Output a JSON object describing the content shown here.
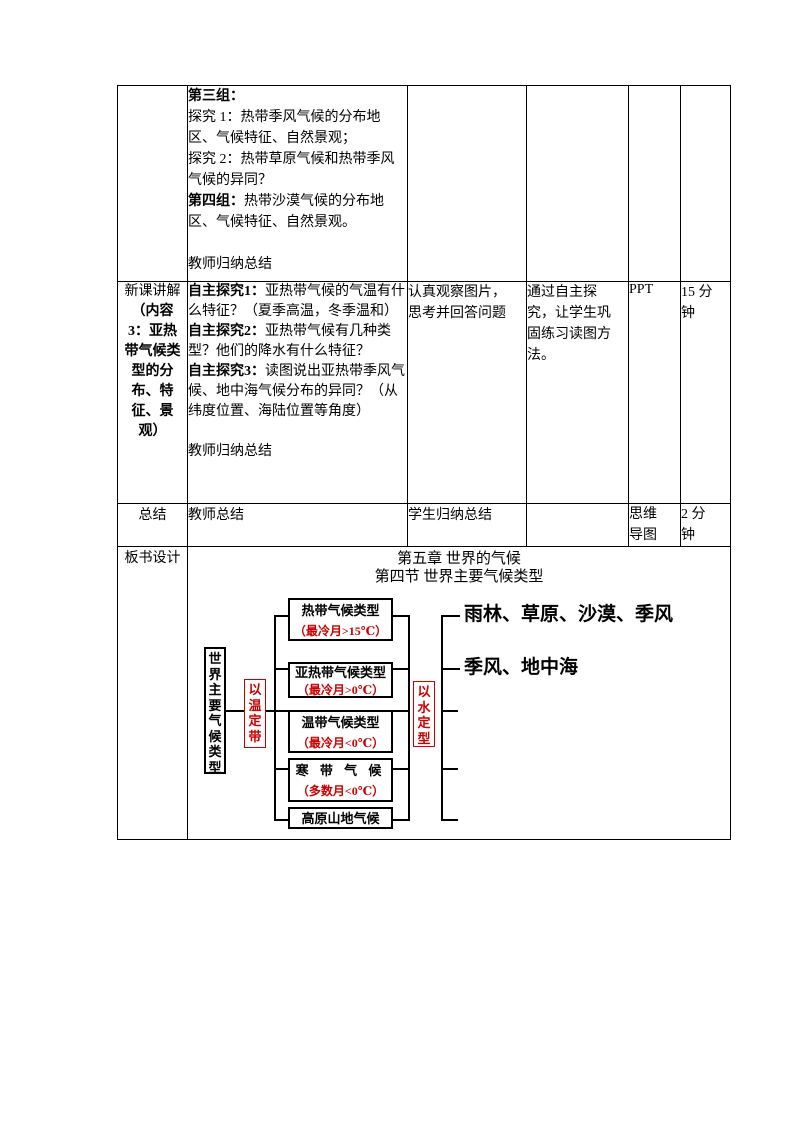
{
  "colors": {
    "accent_red": "#cc0000",
    "border_black": "#000000",
    "page_bg": "#ffffff"
  },
  "table": {
    "row1": {
      "paragraphs": [
        {
          "b": "第三组：",
          "t": ""
        },
        {
          "b": "",
          "t": "探究 1：热带季风气候的分布地区、气候特征、自然景观；"
        },
        {
          "b": "",
          "t": "探究 2：热带草原气候和热带季风气候的异同？"
        },
        {
          "b": "第四组：",
          "t": "热带沙漠气候的分布地区、气候特征、自然景观。"
        },
        {
          "b": "",
          "t": ""
        },
        {
          "b": "",
          "t": "教师归纳总结"
        }
      ]
    },
    "row2": {
      "header_regular": "新课讲解",
      "header_bold": "（内容3：亚热带气候类型的分布、特征、景观）",
      "paragraphs": [
        {
          "b": "自主探究1：",
          "t": "亚热带气候的气温有什么特征？（夏季高温，冬季温和）"
        },
        {
          "b": "自主探究2：",
          "t": "亚热带气候有几种类型？他们的降水有什么特征？"
        },
        {
          "b": "自主探究3：",
          "t": "读图说出亚热带季风气候、地中海气候分布的异同？（从纬度位置、海陆位置等角度）"
        },
        {
          "b": "",
          "t": ""
        },
        {
          "b": "",
          "t": "教师归纳总结"
        }
      ],
      "student_activity": "认真观察图片，\n思考并回答问题",
      "design_intent": "通过自主探\n究，让学生巩\n固练习读图方\n法。",
      "media": "PPT",
      "time": "15 分\n钟"
    },
    "row3": {
      "header": "总结",
      "teacher": "教师总结",
      "student": "学生归纳总结",
      "media": "思维\n导图",
      "time": "2 分\n钟"
    },
    "row4": {
      "header": "板书设计"
    }
  },
  "board": {
    "title1": "第五章 世界的气候",
    "title2": "第四节 世界主要气候类型",
    "root": "世界主要气候类型",
    "temp_rule": "以温定带",
    "water_rule": "以水定型",
    "nodes": [
      {
        "name": "热带气候类型",
        "temp": "（最冷月>15℃）",
        "label": "雨林、草原、沙漠、季风"
      },
      {
        "name": "亚热带气候类型",
        "temp": "（最冷月>0℃）",
        "label": "季风、地中海"
      },
      {
        "name": "温带气候类型",
        "temp": "（最冷月<0℃）",
        "label": ""
      },
      {
        "name": "寒 带 气 候",
        "temp": "（多数月<0℃）",
        "label": ""
      },
      {
        "name": "高原山地气候",
        "temp": "",
        "label": ""
      }
    ]
  }
}
